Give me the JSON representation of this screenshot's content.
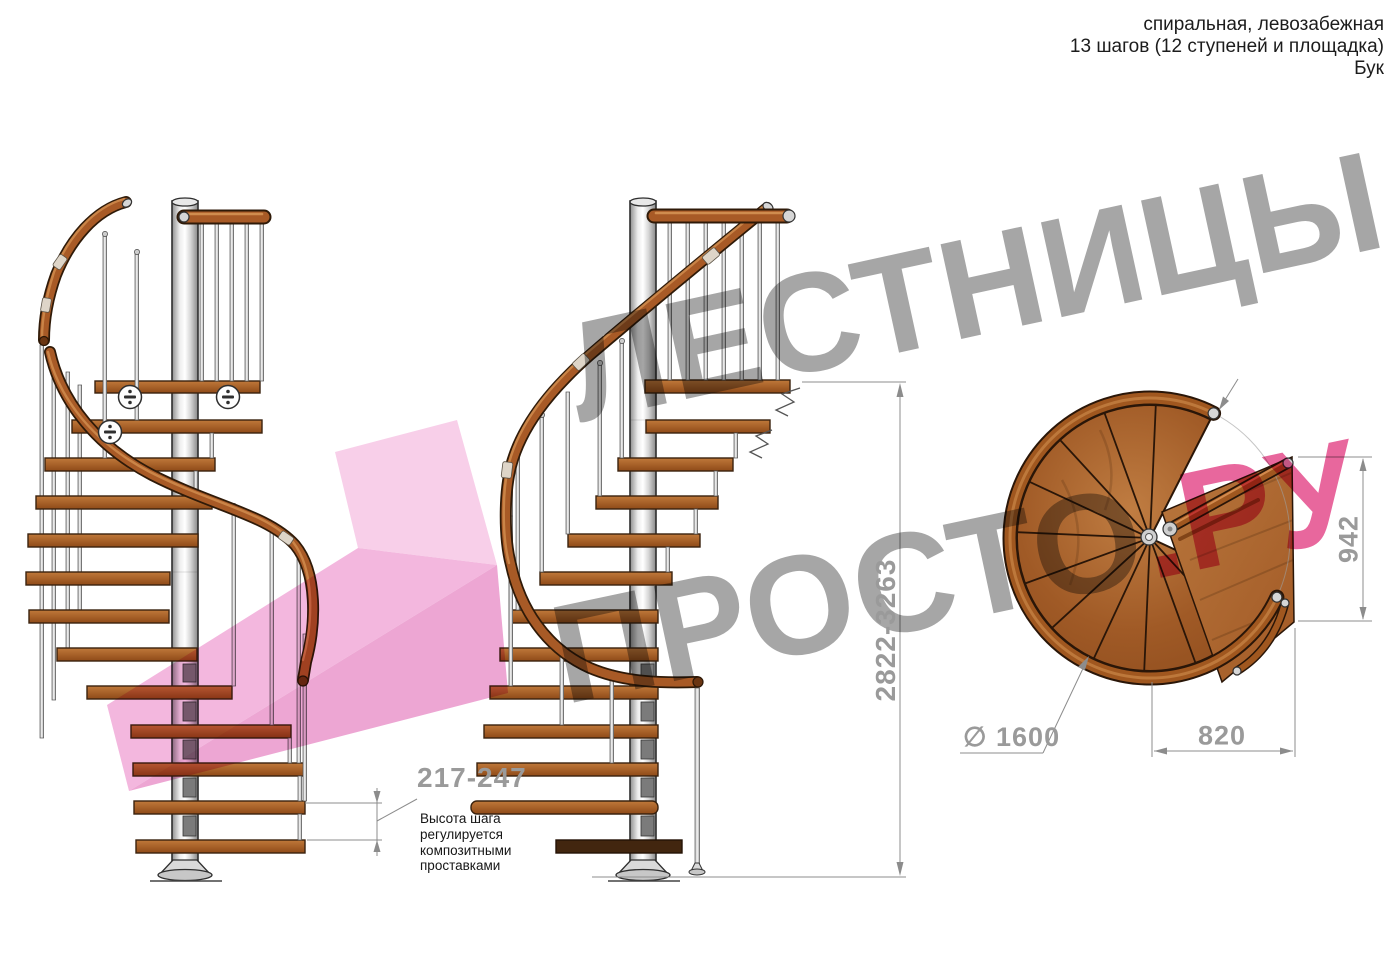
{
  "header": {
    "line1": "спиральная, левозабежная",
    "line2": "13 шагов (12 ступеней и площадка)",
    "line3": "Бук"
  },
  "watermark": {
    "line1": "ЛЕСТНИЦЫ",
    "line2_gray": "ПРОСТО",
    "line2_pink": ".РУ"
  },
  "dimensions": {
    "step_height": {
      "value": "217-247",
      "note": [
        "Высота шага",
        "регулируется",
        "композитными",
        "проставками"
      ]
    },
    "total_height": {
      "value": "2822-3263"
    },
    "plan_height": {
      "value": "942"
    },
    "landing_width": {
      "value": "820"
    },
    "diameter": {
      "value": "∅ 1600"
    }
  },
  "colors": {
    "wood": "#a85a20",
    "pole_metal": "#d9d9d9",
    "dimension_gray": "#9a9a9a",
    "watermark_gray": "#a6a6a6",
    "watermark_pink": "#e8679d",
    "arrow_pink": "#f6c3e5"
  }
}
